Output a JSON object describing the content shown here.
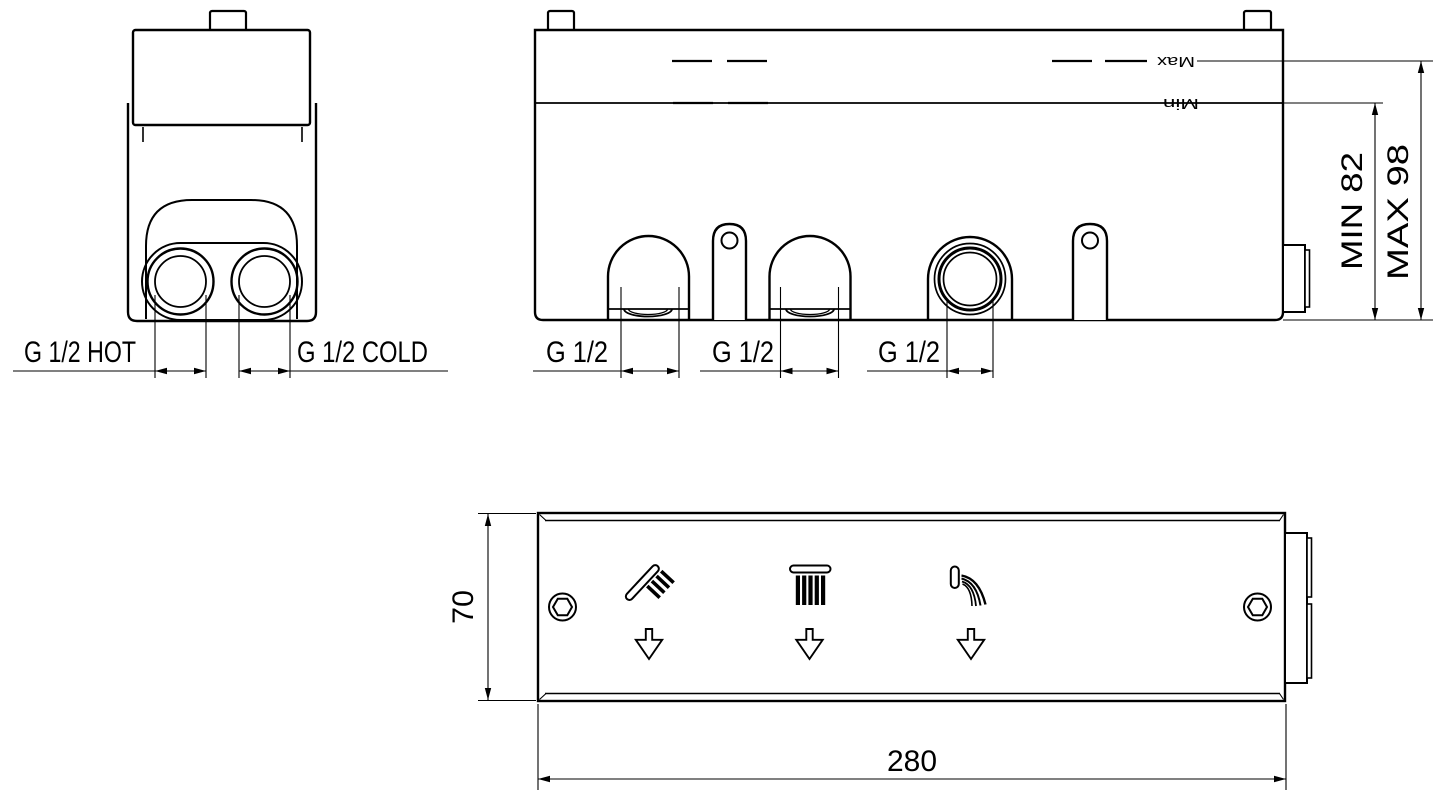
{
  "drawing": {
    "type": "technical-drawing",
    "colors": {
      "line": "#000000",
      "background": "#ffffff"
    },
    "side_view": {
      "hot_label": "G 1/2 HOT",
      "cold_label": "G 1/2 COLD"
    },
    "front_view": {
      "max_marker": "Max",
      "min_marker": "Min",
      "min_depth_label": "MIN 82",
      "max_depth_label": "MAX 98",
      "port_labels": [
        "G 1/2",
        "G 1/2",
        "G 1/2"
      ]
    },
    "panel_view": {
      "height_label": "70",
      "width_label": "280",
      "icons": [
        "hand-shower",
        "rain-shower",
        "spout"
      ]
    }
  }
}
